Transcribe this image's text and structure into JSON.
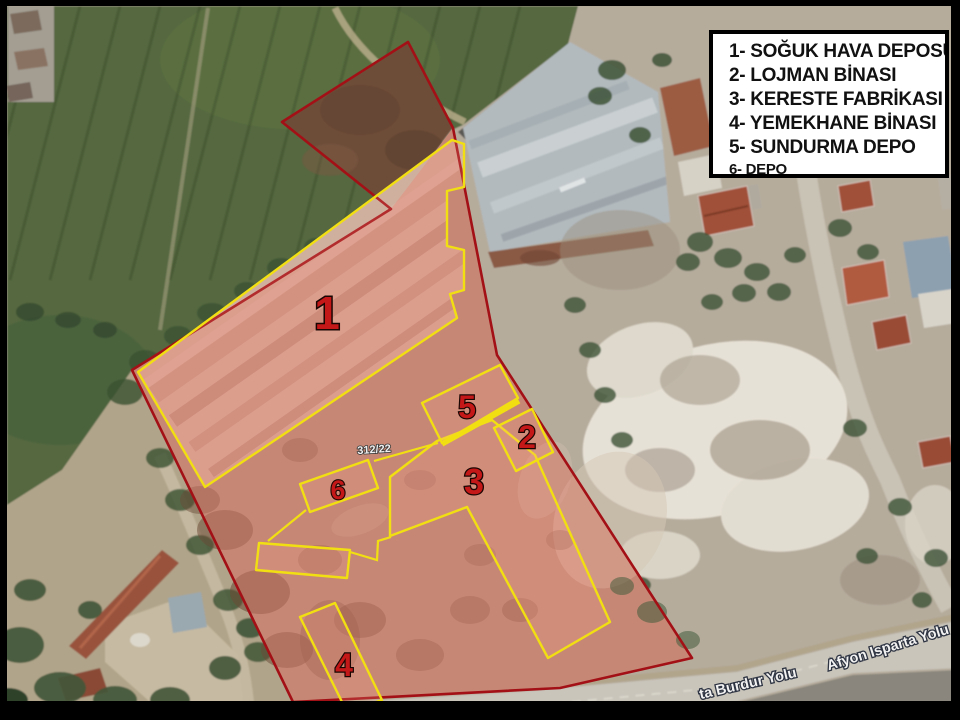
{
  "legend": {
    "items": [
      "1- SOĞUK HAVA DEPOSU",
      "2- LOJMAN BİNASI",
      "3- KERESTE FABRİKASI",
      "4- YEMEKHANE BİNASI",
      "5- SUNDURMA DEPO",
      "6- DEPO"
    ]
  },
  "labels": {
    "building_numbers": [
      "1",
      "2",
      "3",
      "4",
      "5",
      "6"
    ],
    "parcel_number": "312/22",
    "roads": [
      "ta Burdur Yolu",
      "Afyon Isparta Yolu"
    ]
  },
  "colors": {
    "boundary_red": "#a31016",
    "building_outline_yellow": "#f2df12",
    "number_red": "#c41717",
    "legend_bg": "#ffffff",
    "legend_text": "#111111"
  }
}
